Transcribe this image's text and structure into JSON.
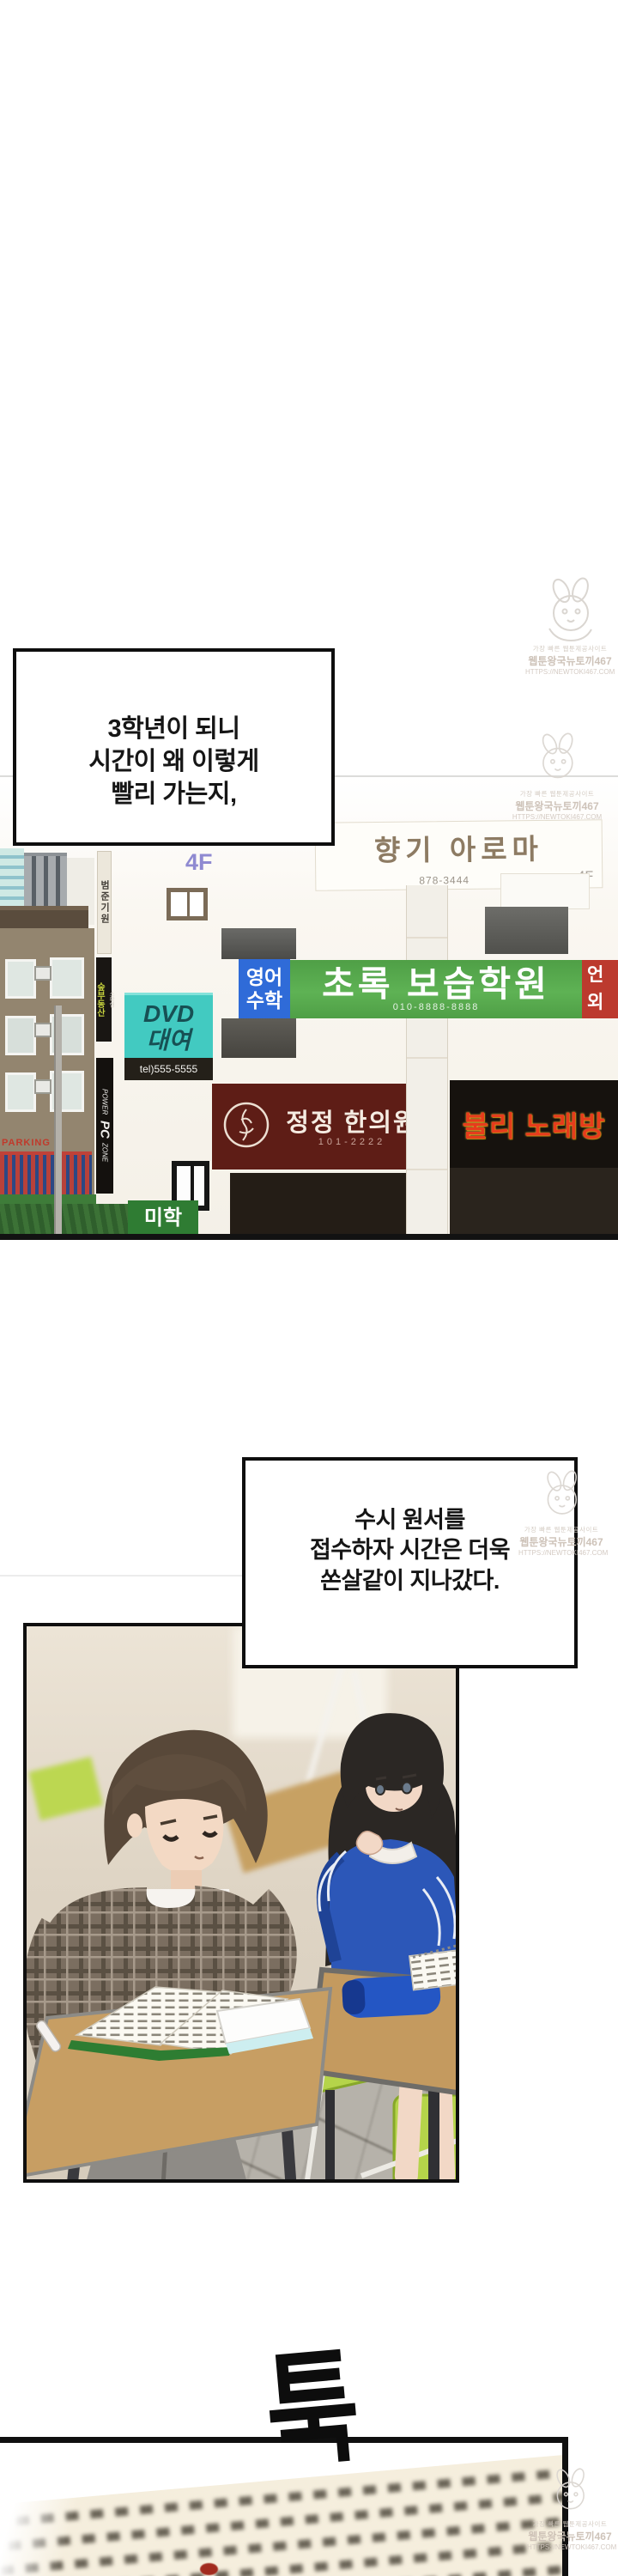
{
  "narration1": {
    "lines": [
      "3학년이 되니",
      "시간이 왜 이렇게",
      "빨리 가는지,"
    ]
  },
  "narration2": {
    "lines": [
      "수시 원서를",
      "접수하자 시간은 더욱",
      "쏜살같이 지나갔다."
    ]
  },
  "watermark": {
    "site_tag": "가장 빠른 웹툰제공사이트",
    "brand": "웹툰왕국뉴토끼467",
    "url": "HTTPS://NEWTOKI467.COM"
  },
  "building": {
    "floor_marker": "4F",
    "aroma": {
      "name": "향기 아로마",
      "phone": "878-3444",
      "floor": "4F"
    },
    "giwon_sign": "범준기원",
    "realty": {
      "tag": "소확행",
      "name": "숲부동산"
    },
    "pc_sign": {
      "l1": "POWER",
      "l2": "PC",
      "l3": "ZONE"
    },
    "parking": "PARKING",
    "english_math": {
      "l1": "영어",
      "l2": "수학"
    },
    "academy": {
      "name": "초록 보습학원",
      "phone": "010-8888-8888"
    },
    "language": {
      "l1": "언",
      "l2": "외"
    },
    "dvd": {
      "l1": "DVD",
      "l2": "대여",
      "tel": "tel)555-5555"
    },
    "hanui": {
      "name": "정정 한의원",
      "phone": "101-2222"
    },
    "karaoke": "불리 노래방",
    "mini_green": "미학"
  },
  "sfx": {
    "impact": "툭"
  },
  "colors": {
    "academy_green": "#57a94d",
    "sign_blue": "#2f6bd8",
    "sign_red": "#bc3a2e",
    "dvd_cyan": "#42cac1",
    "hanui_maroon": "#5e1d16",
    "karaoke_text": "#e63c1c",
    "jacket_blue": "#2c57b8",
    "chair_lime": "#b5d44a"
  }
}
